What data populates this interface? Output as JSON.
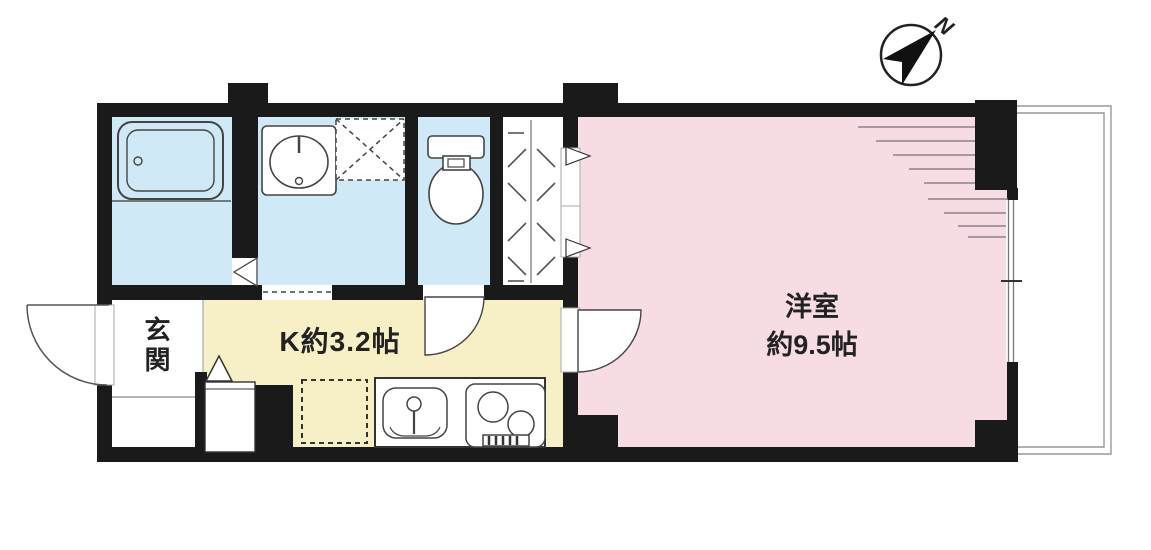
{
  "type": "floor-plan",
  "compass": {
    "label": "N",
    "direction": "northeast"
  },
  "rooms": {
    "entrance": {
      "label": "玄関"
    },
    "kitchen": {
      "label": "K約3.2帖"
    },
    "main_room": {
      "name": "洋室",
      "size": "約9.5帖"
    },
    "bathroom": {
      "fixtures": [
        "bathtub"
      ]
    },
    "washroom": {
      "fixtures": [
        "washbasin",
        "washing-machine-space"
      ]
    },
    "toilet_room": {
      "fixtures": [
        "toilet"
      ]
    },
    "closet": {
      "fixtures": [
        "hanger-rail"
      ]
    },
    "balcony": {
      "fixtures": [
        "sliding-window"
      ]
    }
  },
  "kitchen_fixtures": [
    "refrigerator-space",
    "kitchen-sink",
    "two-burner-stove",
    "shoe-cabinet",
    "entrance-step"
  ],
  "colors": {
    "wall": "#1a1a1a",
    "wet_area": "#cfeaf6",
    "kitchen": "#f7efc5",
    "main_room": "#f8dce4",
    "floor": "#ffffff",
    "outline": "#444444",
    "hatch_line": "#8d8189",
    "thin_line": "#999999"
  }
}
